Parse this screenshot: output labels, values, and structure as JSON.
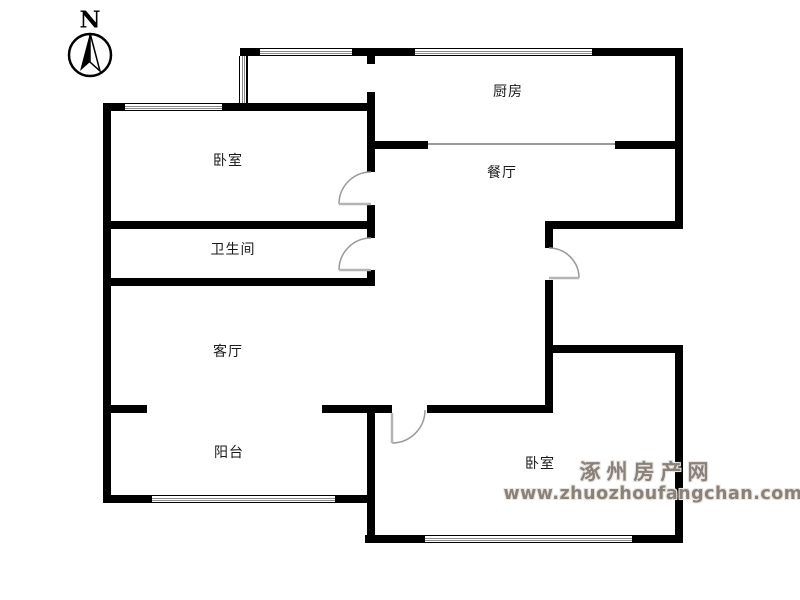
{
  "compass": {
    "label": "N"
  },
  "rooms": {
    "kitchen": "厨房",
    "dining": "餐厅",
    "bedroom_nw": "卧室",
    "bathroom": "卫生间",
    "living": "客厅",
    "balcony": "阳台",
    "bedroom_se": "卧室"
  },
  "watermark": {
    "site_name": "涿州房产网",
    "site_url": "www.zhuozhoufangchan.com",
    "color": "#8a8178"
  },
  "colors": {
    "wall": "#000000",
    "thin_line": "#9a9a9a",
    "background": "#ffffff"
  }
}
